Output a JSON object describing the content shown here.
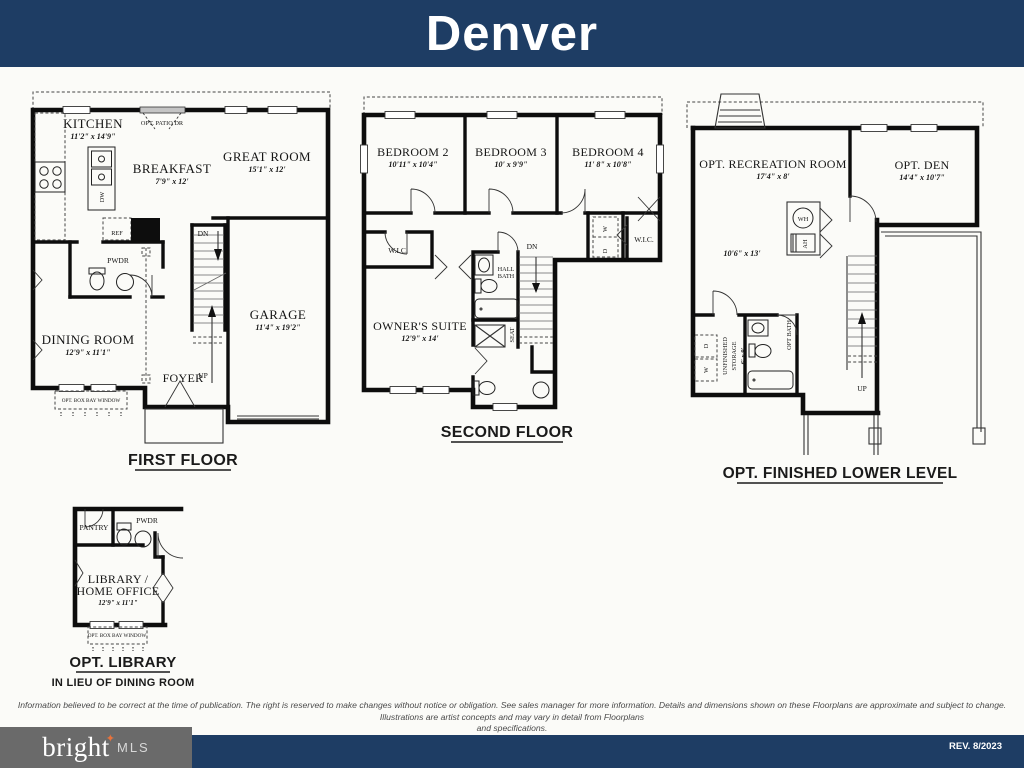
{
  "header": {
    "title": "Denver"
  },
  "ff": {
    "title": "FIRST FLOOR",
    "kitchen": {
      "name": "KITCHEN",
      "dim": "11'2\" x 14'9\""
    },
    "breakfast": {
      "name": "BREAKFAST",
      "dim": "7'9\" x 12'"
    },
    "great_room": {
      "name": "GREAT ROOM",
      "dim": "15'1\" x 12'"
    },
    "dining": {
      "name": "DINING ROOM",
      "dim": "12'9\" x 11'1\""
    },
    "garage": {
      "name": "GARAGE",
      "dim": "11'4\" x 19'2\""
    },
    "foyer": "FOYER",
    "pwdr": "PWDR",
    "ref": "REF",
    "dw": "DW",
    "up": "UP",
    "dn": "DN",
    "opt_patio": "OPT. PATIO DR",
    "box_bay": "OPT. BOX BAY WINDOW"
  },
  "sf": {
    "title": "SECOND FLOOR",
    "bedroom2": {
      "name": "BEDROOM 2",
      "dim": "10'11\" x 10'4\""
    },
    "bedroom3": {
      "name": "BEDROOM 3",
      "dim": "10'  x 9'9\""
    },
    "bedroom4": {
      "name": "BEDROOM 4",
      "dim": "11' 8\" x 10'8\""
    },
    "owners": {
      "name": "OWNER'S SUITE",
      "dim": "12'9\" x 14'"
    },
    "wic_left": "W.I.C.",
    "wic_right": "W.I.C.",
    "hall_bath_1": "HALL",
    "hall_bath_2": "BATH",
    "seat": "SEAT",
    "dn": "DN",
    "washer": "W",
    "dryer": "D"
  },
  "ll": {
    "title": "OPT. FINISHED LOWER LEVEL",
    "rec": {
      "name": "OPT. RECREATION  ROOM",
      "dim": "17'4\" x 8'"
    },
    "den": {
      "name": "OPT. DEN",
      "dim": "14'4\" x 10'7\""
    },
    "area_dim": "10'6\" x 13'",
    "storage_1": "UNFINISHED",
    "storage_2": "STORAGE",
    "storage_dim": "6' x 9'",
    "opt_bath": "OPT BATH",
    "wh": "WH",
    "ah": "AH",
    "washer": "W",
    "dryer": "D",
    "up": "UP"
  },
  "lib": {
    "title": "OPT. LIBRARY",
    "subtitle": "IN LIEU OF DINING ROOM",
    "name_1": "LIBRARY /",
    "name_2": "HOME OFFICE",
    "dim": "12'9\" x 11'1\"",
    "pantry": "PANTRY",
    "pwdr": "PWDR",
    "box_bay": "OPT. BOX BAY WINDOW"
  },
  "disclaimer": {
    "line1": "Information believed to be correct at the time of publication. The right is reserved to make changes without notice or obligation. See sales manager for more information. Details and dimensions shown on these Floorplans are approximate and subject to change. Illustrations are artist concepts and may vary in detail from Floorplans",
    "line2": "and specifications."
  },
  "footer": {
    "brand": "bright",
    "star": "✦",
    "suffix": "MLS",
    "rev": "REV. 8/2023"
  },
  "colors": {
    "navy": "#1e3d64",
    "logo_gray": "#6a6a6a",
    "orange": "#e8733c",
    "wall": "#0d0d0d"
  }
}
